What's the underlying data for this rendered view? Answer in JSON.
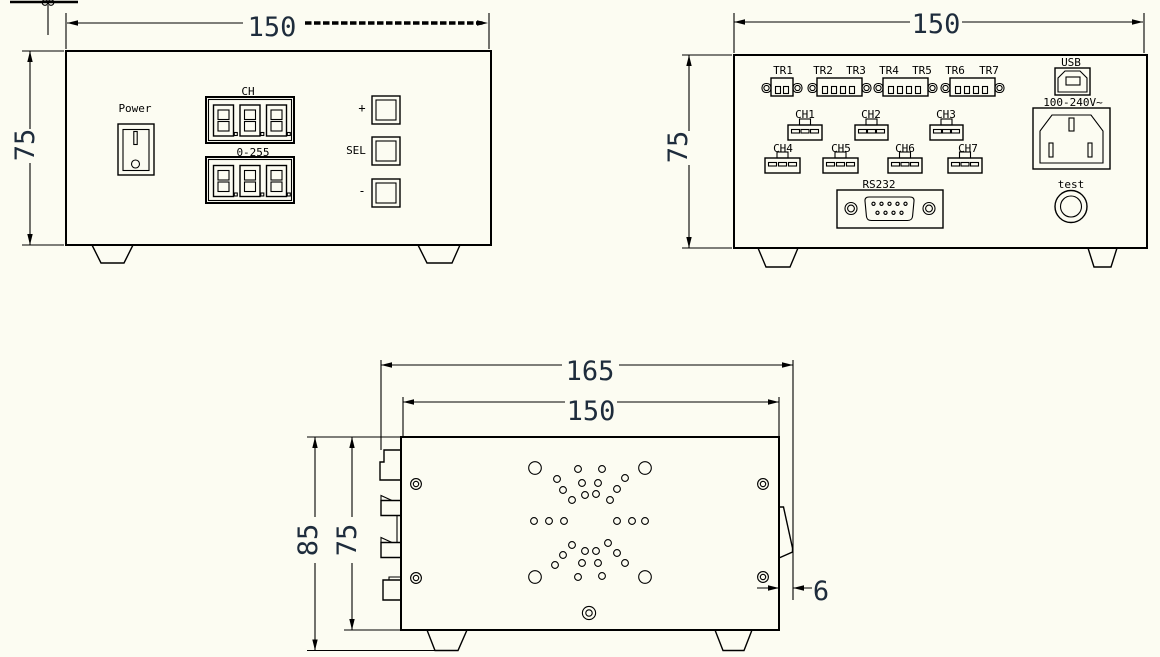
{
  "colors": {
    "background": "#fcfcf2",
    "line": "#000000",
    "dim_text": "#1e2c3c"
  },
  "front_view": {
    "dim_width": "150",
    "dim_height": "75",
    "power_label": "Power",
    "channel_display_label": "CH",
    "value_display_label": "0-255",
    "button_plus": "+",
    "button_sel": "SEL",
    "button_minus": "-"
  },
  "back_view": {
    "dim_width": "150",
    "dim_height": "75",
    "tr_labels": [
      "TR1",
      "TR2",
      "TR3",
      "TR4",
      "TR5",
      "TR6",
      "TR7"
    ],
    "ch_labels": [
      "CH1",
      "CH2",
      "CH3",
      "CH4",
      "CH5",
      "CH6",
      "CH7"
    ],
    "rs232_label": "RS232",
    "usb_label": "USB",
    "ac_input_label": "100-240V~",
    "test_label": "test"
  },
  "bottom_view": {
    "dim_outer_width": "165",
    "dim_body_width": "150",
    "dim_outer_height": "85",
    "dim_body_height": "75",
    "dim_side_tab": "6"
  }
}
